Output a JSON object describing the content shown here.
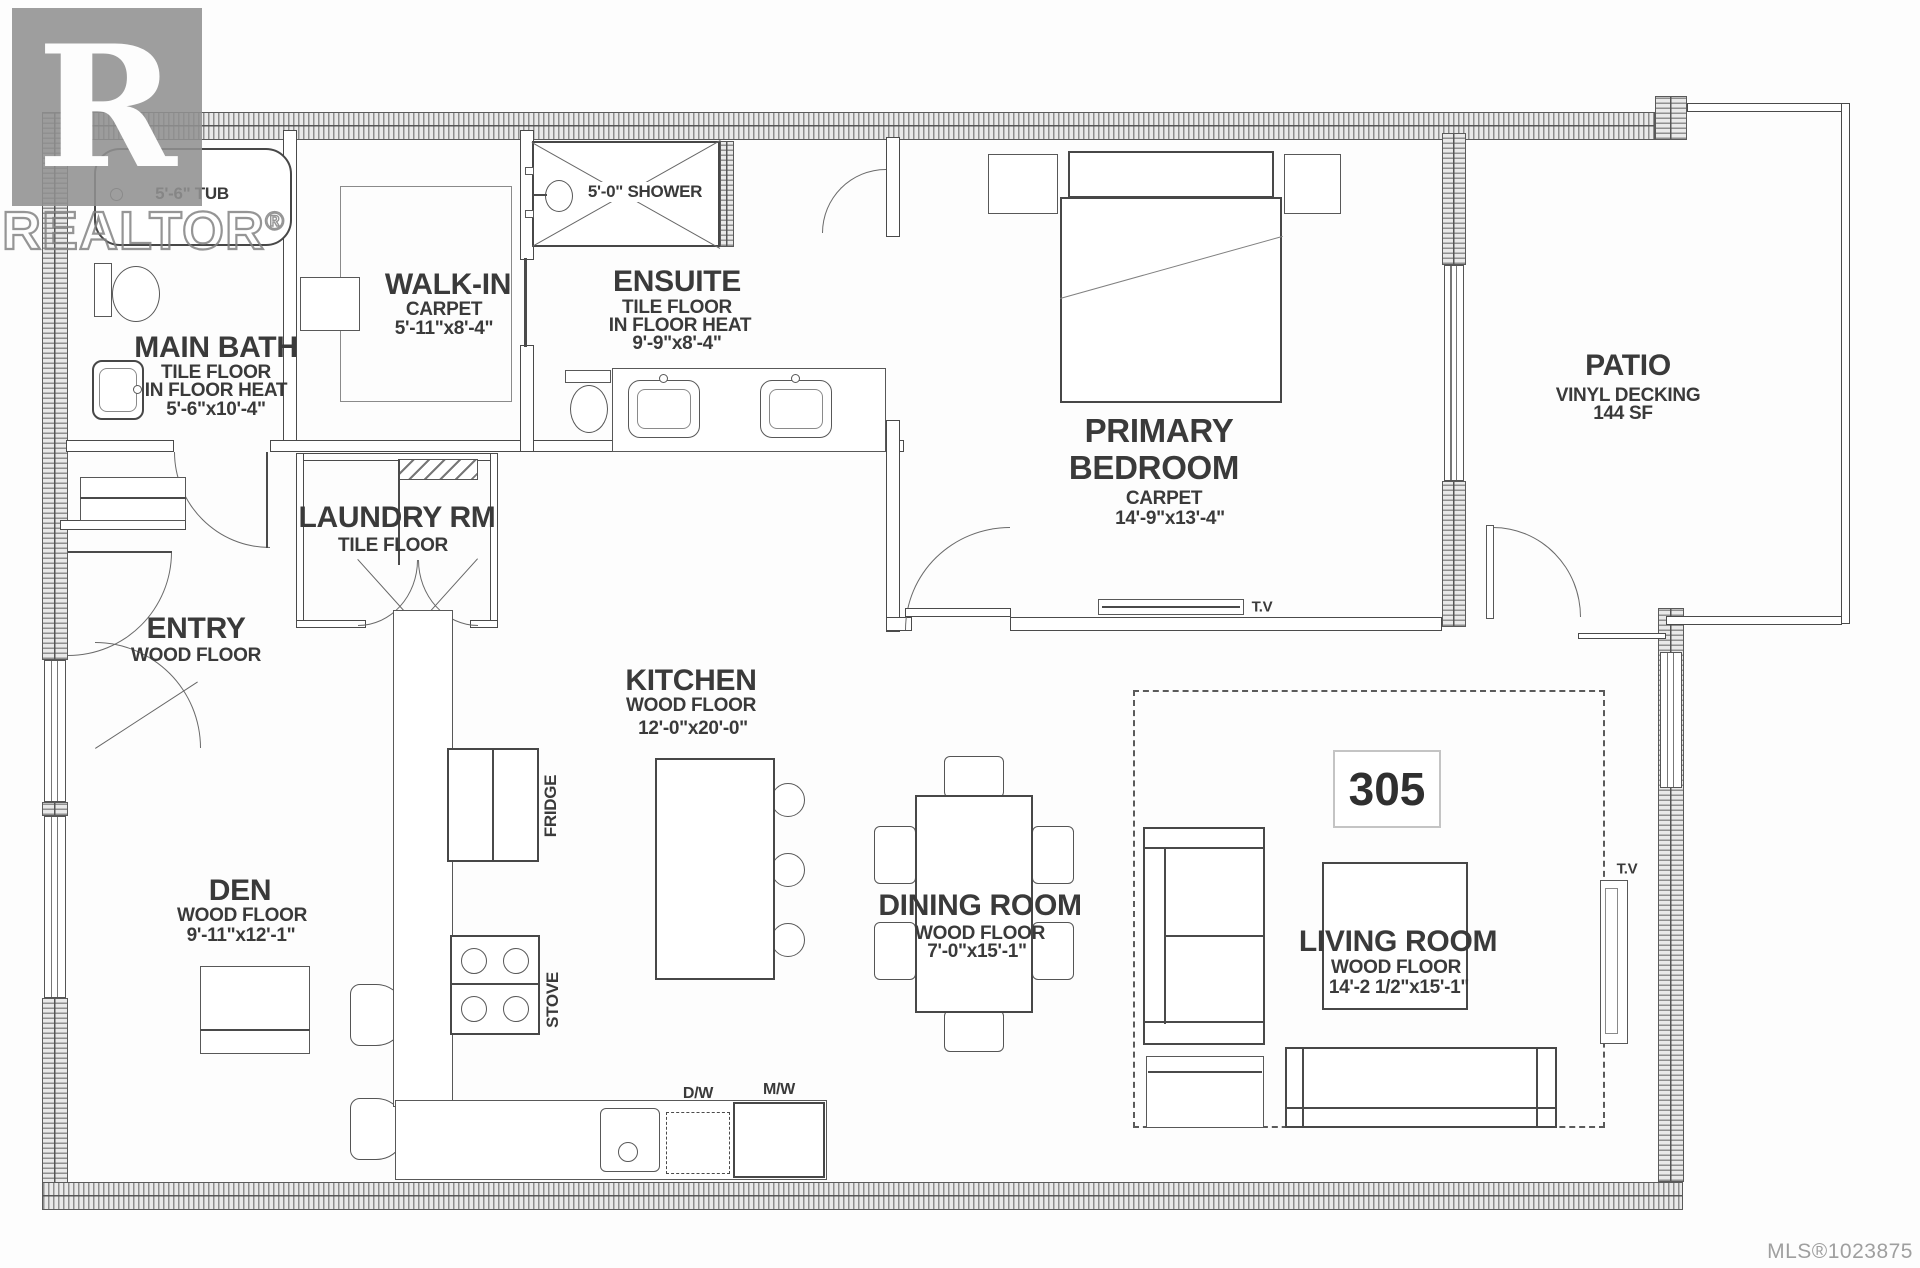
{
  "watermark": {
    "logo_letter": "R",
    "name": "REALTOR",
    "reg": "®"
  },
  "unit": {
    "number": "305"
  },
  "footer": {
    "mls_number": "MLS®1023875"
  },
  "colors": {
    "line": "#4a4a4a",
    "watermark_gray": "#9c9c9c",
    "wall_fill": "#e9e9e9",
    "unit_box_border": "#c4c4c4"
  },
  "rooms": {
    "main_bath": {
      "name": "MAIN BATH",
      "floor": "TILE FLOOR",
      "heat": "IN FLOOR HEAT",
      "dims": "5'-6\"x10'-4\""
    },
    "walk_in": {
      "name": "WALK-IN",
      "floor": "CARPET",
      "dims": "5'-11\"x8'-4\""
    },
    "ensuite": {
      "name": "ENSUITE",
      "floor": "TILE FLOOR",
      "heat": "IN FLOOR HEAT",
      "dims": "9'-9\"x8'-4\""
    },
    "laundry": {
      "name": "LAUNDRY RM",
      "floor": "TILE FLOOR"
    },
    "entry": {
      "name": "ENTRY",
      "floor": "WOOD FLOOR"
    },
    "primary_bedroom": {
      "name_line1": "PRIMARY",
      "name_line2": "BEDROOM",
      "floor": "CARPET",
      "dims": "14'-9\"x13'-4\""
    },
    "patio": {
      "name": "PATIO",
      "floor": "VINYL DECKING",
      "area": "144 SF"
    },
    "kitchen": {
      "name": "KITCHEN",
      "floor": "WOOD FLOOR",
      "dims": "12'-0\"x20'-0\""
    },
    "den": {
      "name": "DEN",
      "floor": "WOOD FLOOR",
      "dims": "9'-11\"x12'-1\""
    },
    "dining": {
      "name": "DINING ROOM",
      "floor": "WOOD FLOOR",
      "dims": "7'-0\"x15'-1\""
    },
    "living": {
      "name": "LIVING ROOM",
      "floor": "WOOD FLOOR",
      "dims": "14'-2 1/2\"x15'-1\""
    }
  },
  "fixtures": {
    "tub_label": "5'-6\" TUB",
    "shower_label": "5'-0\" SHOWER",
    "fridge_label": "FRIDGE",
    "stove_label": "STOVE",
    "dishwasher_label": "D/W",
    "microwave_label": "M/W",
    "tv_bedroom_label": "T.V",
    "tv_living_label": "T.V"
  }
}
